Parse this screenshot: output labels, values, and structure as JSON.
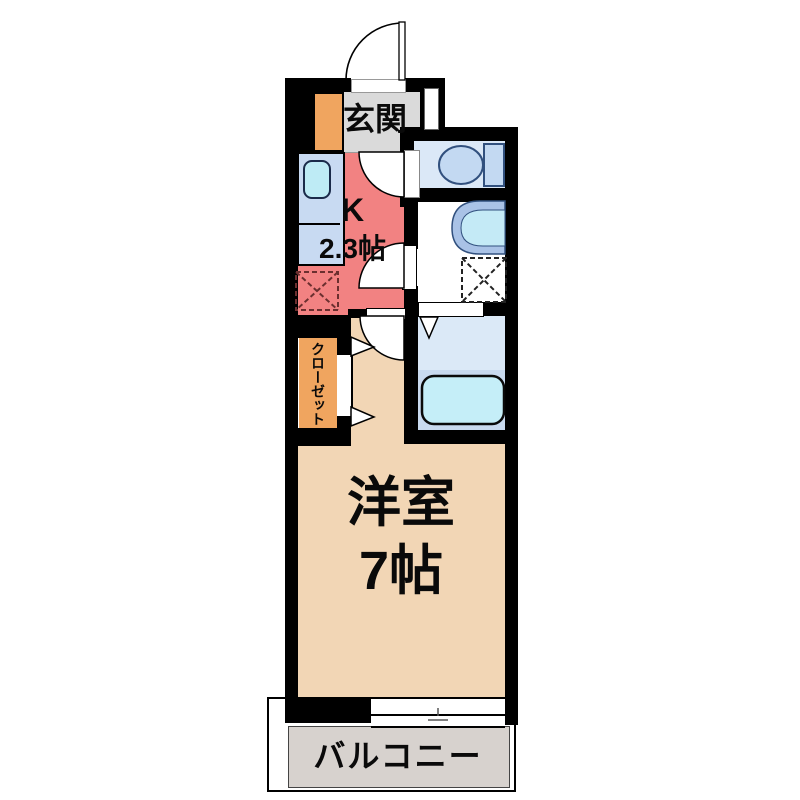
{
  "plan": {
    "type": "apartment-floorplan-1K",
    "labels": {
      "entrance": "玄関",
      "kitchen_name": "K",
      "kitchen_size": "2.3帖",
      "closet": "クローゼット",
      "room_name": "洋室",
      "room_size": "7帖",
      "balcony": "バルコニー"
    },
    "colors": {
      "wall": "#000000",
      "entrance_floor": "#DADADA",
      "shoe_cabinet": "#F0A55F",
      "kitchen_floor": "#F28282",
      "counter": "#C8DAF2",
      "kitchen_sink": "#BEEBF5",
      "closet": "#F0A55F",
      "room_floor": "#F2D6B5",
      "toilet_floor": "#DBE8F7",
      "toilet_fixture": "#C3D9F2",
      "washroom_floor": "#FFFFFF",
      "washbasin_rim": "#A9C2E6",
      "washbasin_bowl": "#C4EAF6",
      "bath_floor_upper": "#DBE9F7",
      "bath_floor_lower": "#C9DAEF",
      "bathtub": "#C5EEF8",
      "balcony_floor": "#D7D2CE"
    },
    "fixtures": [
      {
        "name": "entry-door",
        "type": "swing-door"
      },
      {
        "name": "kitchen-counter-sink",
        "type": "kitchen-sink"
      },
      {
        "name": "refrigerator-space",
        "type": "dashed-square"
      },
      {
        "name": "toilet",
        "type": "toilet"
      },
      {
        "name": "washbasin",
        "type": "sink"
      },
      {
        "name": "washing-machine-space",
        "type": "dashed-square"
      },
      {
        "name": "bathtub",
        "type": "bathtub"
      },
      {
        "name": "closet-doors",
        "type": "bifold"
      },
      {
        "name": "balcony-window",
        "type": "sliding-window"
      }
    ]
  }
}
